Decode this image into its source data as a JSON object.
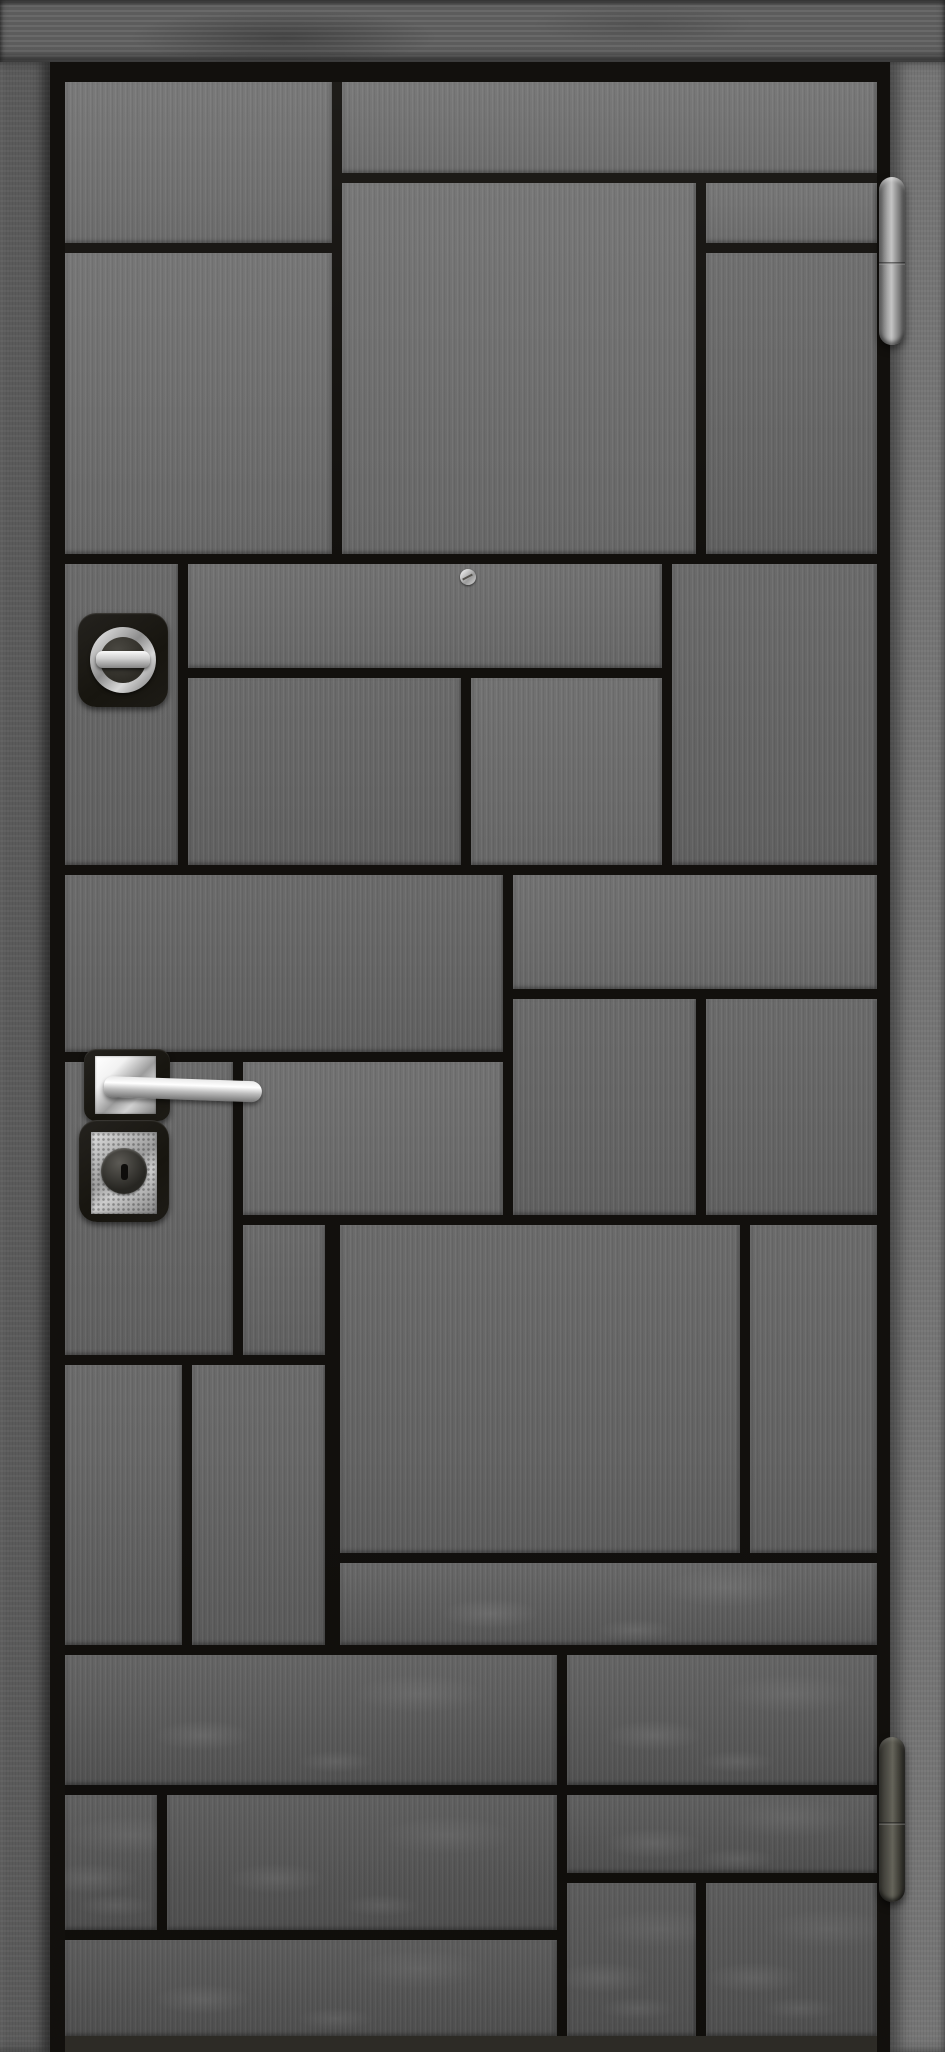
{
  "scene": {
    "subject": "entry-door-product-photo",
    "description": "Dark gray metal entry door with mosaic of rectangular wood-textured panels separated by black grooves, set in a gray concrete frame",
    "visible_text": ""
  },
  "colors": {
    "wall": "#646464",
    "wall_left": "#5a5a5a",
    "wall_right": "#757575",
    "door_groove": "#12100d",
    "panel_light": "#727272",
    "panel_dark": "#5b5b5b",
    "hardware_black": "#1b1916",
    "chrome": "#f2f2f2",
    "hinge_top_metal": "#c4c4c4",
    "hinge_bottom_metal": "#65645a"
  },
  "frame": {
    "lintel": {
      "x": 0,
      "y": 0,
      "w": 945,
      "h": 62
    },
    "left": {
      "x": 0,
      "y": 62,
      "w": 50,
      "h": 1990
    },
    "right": {
      "x": 890,
      "y": 62,
      "w": 55,
      "h": 1990
    },
    "leaf": {
      "x": 50,
      "y": 62,
      "w": 840,
      "h": 1990
    }
  },
  "door": {
    "face": {
      "x": 65,
      "y": 82,
      "w": 812,
      "h": 1954
    },
    "panels": [
      {
        "x": 65,
        "y": 82,
        "w": 267,
        "h": 161,
        "tone": "a"
      },
      {
        "x": 342,
        "y": 82,
        "w": 535,
        "h": 91,
        "tone": "a"
      },
      {
        "x": 65,
        "y": 253,
        "w": 267,
        "h": 301,
        "tone": "a"
      },
      {
        "x": 342,
        "y": 183,
        "w": 354,
        "h": 371,
        "tone": "a"
      },
      {
        "x": 706,
        "y": 183,
        "w": 171,
        "h": 60,
        "tone": "a"
      },
      {
        "x": 706,
        "y": 253,
        "w": 171,
        "h": 301,
        "tone": "b"
      },
      {
        "x": 65,
        "y": 564,
        "w": 113,
        "h": 301,
        "tone": "b"
      },
      {
        "x": 188,
        "y": 564,
        "w": 474,
        "h": 104,
        "tone": "a"
      },
      {
        "x": 188,
        "y": 678,
        "w": 273,
        "h": 187,
        "tone": "b"
      },
      {
        "x": 471,
        "y": 678,
        "w": 191,
        "h": 187,
        "tone": "a"
      },
      {
        "x": 672,
        "y": 564,
        "w": 205,
        "h": 301,
        "tone": "b"
      },
      {
        "x": 65,
        "y": 875,
        "w": 438,
        "h": 177,
        "tone": "b"
      },
      {
        "x": 513,
        "y": 875,
        "w": 364,
        "h": 114,
        "tone": "a"
      },
      {
        "x": 513,
        "y": 999,
        "w": 183,
        "h": 216,
        "tone": "b"
      },
      {
        "x": 706,
        "y": 999,
        "w": 171,
        "h": 216,
        "tone": "b"
      },
      {
        "x": 65,
        "y": 1062,
        "w": 168,
        "h": 293,
        "tone": "b"
      },
      {
        "x": 243,
        "y": 1062,
        "w": 260,
        "h": 153,
        "tone": "a"
      },
      {
        "x": 243,
        "y": 1225,
        "w": 82,
        "h": 130,
        "tone": "b"
      },
      {
        "x": 340,
        "y": 1225,
        "w": 400,
        "h": 328,
        "tone": "b"
      },
      {
        "x": 750,
        "y": 1225,
        "w": 127,
        "h": 328,
        "tone": "b"
      },
      {
        "x": 65,
        "y": 1365,
        "w": 117,
        "h": 280,
        "tone": "b"
      },
      {
        "x": 192,
        "y": 1365,
        "w": 133,
        "h": 280,
        "tone": "b"
      },
      {
        "x": 340,
        "y": 1563,
        "w": 537,
        "h": 82,
        "tone": "c"
      },
      {
        "x": 65,
        "y": 1655,
        "w": 492,
        "h": 130,
        "tone": "c"
      },
      {
        "x": 567,
        "y": 1655,
        "w": 310,
        "h": 130,
        "tone": "c"
      },
      {
        "x": 65,
        "y": 1795,
        "w": 92,
        "h": 135,
        "tone": "c"
      },
      {
        "x": 167,
        "y": 1795,
        "w": 390,
        "h": 135,
        "tone": "c"
      },
      {
        "x": 567,
        "y": 1795,
        "w": 310,
        "h": 78,
        "tone": "c"
      },
      {
        "x": 65,
        "y": 1940,
        "w": 492,
        "h": 96,
        "tone": "c"
      },
      {
        "x": 567,
        "y": 1883,
        "w": 129,
        "h": 153,
        "tone": "c"
      },
      {
        "x": 706,
        "y": 1883,
        "w": 171,
        "h": 153,
        "tone": "c"
      }
    ]
  },
  "hardware": {
    "thumb_turn": {
      "plate": {
        "x": 78,
        "y": 613,
        "w": 90,
        "h": 94,
        "r": 18
      },
      "ring": {
        "cx": 123,
        "cy": 660,
        "r": 33
      },
      "inner": {
        "cx": 123,
        "cy": 660,
        "r": 23
      },
      "bar": {
        "x": 96,
        "y": 651,
        "w": 54,
        "h": 17
      }
    },
    "peephole_screw": {
      "cx": 468,
      "cy": 577,
      "r": 8
    },
    "handle": {
      "backplate": {
        "x": 84,
        "y": 1049,
        "w": 86,
        "h": 72,
        "r": 12
      },
      "rose": {
        "x": 95,
        "y": 1056,
        "w": 61,
        "h": 58
      },
      "lever": {
        "x": 104,
        "y": 1076,
        "w": 158,
        "h": 21,
        "angle": 2
      }
    },
    "cylinder": {
      "backplate": {
        "x": 79,
        "y": 1120,
        "w": 90,
        "h": 102,
        "r": 18
      },
      "plate": {
        "x": 91,
        "y": 1132,
        "w": 66,
        "h": 82
      },
      "core": {
        "cx": 124,
        "cy": 1171,
        "r": 23
      },
      "keyhole": {
        "x": 121,
        "y": 1164,
        "w": 7,
        "h": 16
      }
    },
    "hinges": [
      {
        "x": 879,
        "y": 177,
        "w": 26,
        "h": 168,
        "seam_y": 262,
        "finish": "bright"
      },
      {
        "x": 879,
        "y": 1737,
        "w": 26,
        "h": 165,
        "seam_y": 1822,
        "finish": "dark"
      }
    ]
  }
}
